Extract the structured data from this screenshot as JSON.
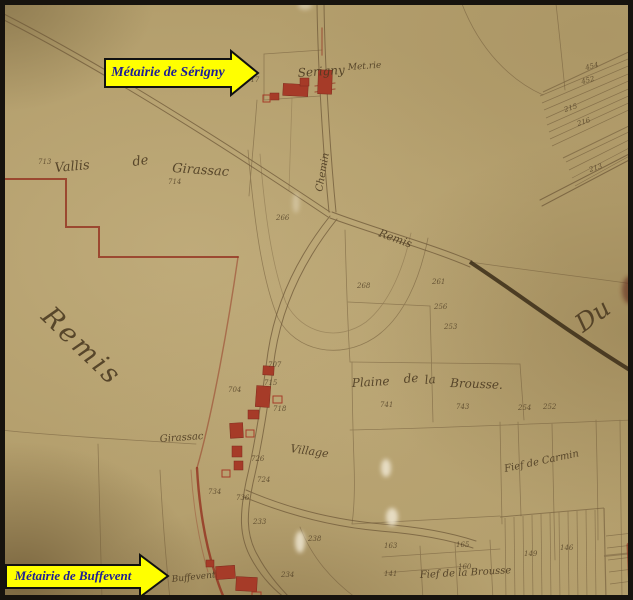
{
  "annotations": {
    "serigny": {
      "label": "Métairie de Sérigny"
    },
    "buffevent": {
      "label": "Métairie de Buffevent"
    }
  },
  "map": {
    "colors": {
      "paper": "#b39e6c",
      "ink": "#6f5939",
      "script": "#4a3920",
      "building": "#a63b28",
      "boundary_red": "#93311f",
      "road_dark": "#3b2d18",
      "arrow_fill": "#ffff00",
      "arrow_border": "#111111",
      "arrow_text": "#1d1d96"
    },
    "place_labels": [
      {
        "id": "serigny-hamlet",
        "text": "Serigny",
        "x": 298,
        "y": 77,
        "size": 12,
        "rot": -4
      },
      {
        "id": "serigny-met",
        "text": "Met.rie",
        "x": 348,
        "y": 70,
        "size": 9,
        "rot": -4
      },
      {
        "id": "chemin",
        "text": "Chemin",
        "x": 322,
        "y": 192,
        "size": 10,
        "rot": -80
      },
      {
        "id": "remis-road",
        "text": "Remis",
        "x": 378,
        "y": 236,
        "size": 11,
        "rot": 20
      },
      {
        "id": "vallis",
        "text": "Vallis",
        "x": 55,
        "y": 172,
        "size": 13,
        "rot": -5
      },
      {
        "id": "vallis-de",
        "text": "de",
        "x": 133,
        "y": 166,
        "size": 13,
        "rot": -8
      },
      {
        "id": "vallis-girassac",
        "text": "Girassac",
        "x": 172,
        "y": 172,
        "size": 13,
        "rot": 4
      },
      {
        "id": "remis-big",
        "text": "Remis",
        "x": 40,
        "y": 318,
        "size": 27,
        "rot": 44,
        "ls": 3
      },
      {
        "id": "du-big",
        "text": "Du",
        "x": 583,
        "y": 333,
        "size": 25,
        "rot": -36
      },
      {
        "id": "plaine",
        "text": "Plaine",
        "x": 352,
        "y": 387,
        "size": 12,
        "rot": -3
      },
      {
        "id": "plaine-de",
        "text": "de",
        "x": 404,
        "y": 383,
        "size": 12,
        "rot": -5
      },
      {
        "id": "plaine-la",
        "text": "la",
        "x": 425,
        "y": 384,
        "size": 12,
        "rot": -5
      },
      {
        "id": "plaine-brousse",
        "text": "Brousse.",
        "x": 450,
        "y": 387,
        "size": 12,
        "rot": 2
      },
      {
        "id": "girassac-village",
        "text": "Girassac",
        "x": 160,
        "y": 442,
        "size": 10,
        "rot": -4
      },
      {
        "id": "village",
        "text": "Village",
        "x": 290,
        "y": 452,
        "size": 11,
        "rot": 8
      },
      {
        "id": "fief-carmin",
        "text": "Fief de Carmin",
        "x": 505,
        "y": 472,
        "size": 10,
        "rot": -12
      },
      {
        "id": "fief-brousse",
        "text": "Fief de la Brousse",
        "x": 420,
        "y": 578,
        "size": 10,
        "rot": -3
      },
      {
        "id": "buffevent-hamlet",
        "text": "Buffevent",
        "x": 172,
        "y": 582,
        "size": 9,
        "rot": -6
      }
    ],
    "parcel_numbers": [
      {
        "n": "717",
        "x": 246,
        "y": 82
      },
      {
        "n": "713",
        "x": 38,
        "y": 164
      },
      {
        "n": "714",
        "x": 168,
        "y": 184
      },
      {
        "n": "266",
        "x": 276,
        "y": 220
      },
      {
        "n": "268",
        "x": 357,
        "y": 288
      },
      {
        "n": "261",
        "x": 432,
        "y": 284
      },
      {
        "n": "256",
        "x": 434,
        "y": 309
      },
      {
        "n": "253",
        "x": 444,
        "y": 329
      },
      {
        "n": "254",
        "x": 518,
        "y": 410
      },
      {
        "n": "252",
        "x": 543,
        "y": 409
      },
      {
        "n": "741",
        "x": 380,
        "y": 407
      },
      {
        "n": "743",
        "x": 456,
        "y": 409
      },
      {
        "n": "707",
        "x": 268,
        "y": 367
      },
      {
        "n": "715",
        "x": 264,
        "y": 385
      },
      {
        "n": "704",
        "x": 228,
        "y": 392
      },
      {
        "n": "718",
        "x": 273,
        "y": 411
      },
      {
        "n": "726",
        "x": 251,
        "y": 461
      },
      {
        "n": "724",
        "x": 257,
        "y": 482
      },
      {
        "n": "734",
        "x": 208,
        "y": 494
      },
      {
        "n": "736",
        "x": 236,
        "y": 500
      },
      {
        "n": "233",
        "x": 253,
        "y": 524
      },
      {
        "n": "238",
        "x": 308,
        "y": 541
      },
      {
        "n": "234",
        "x": 281,
        "y": 577
      },
      {
        "n": "163",
        "x": 384,
        "y": 548
      },
      {
        "n": "165",
        "x": 456,
        "y": 547
      },
      {
        "n": "141",
        "x": 384,
        "y": 576
      },
      {
        "n": "160",
        "x": 458,
        "y": 569
      },
      {
        "n": "454",
        "x": 586,
        "y": 70,
        "rot": -15
      },
      {
        "n": "452",
        "x": 582,
        "y": 84,
        "rot": -15
      },
      {
        "n": "215",
        "x": 565,
        "y": 112,
        "rot": -18
      },
      {
        "n": "216",
        "x": 578,
        "y": 126,
        "rot": -18
      },
      {
        "n": "213",
        "x": 590,
        "y": 172,
        "rot": -18
      },
      {
        "n": "149",
        "x": 524,
        "y": 556
      },
      {
        "n": "146",
        "x": 560,
        "y": 550
      }
    ]
  }
}
